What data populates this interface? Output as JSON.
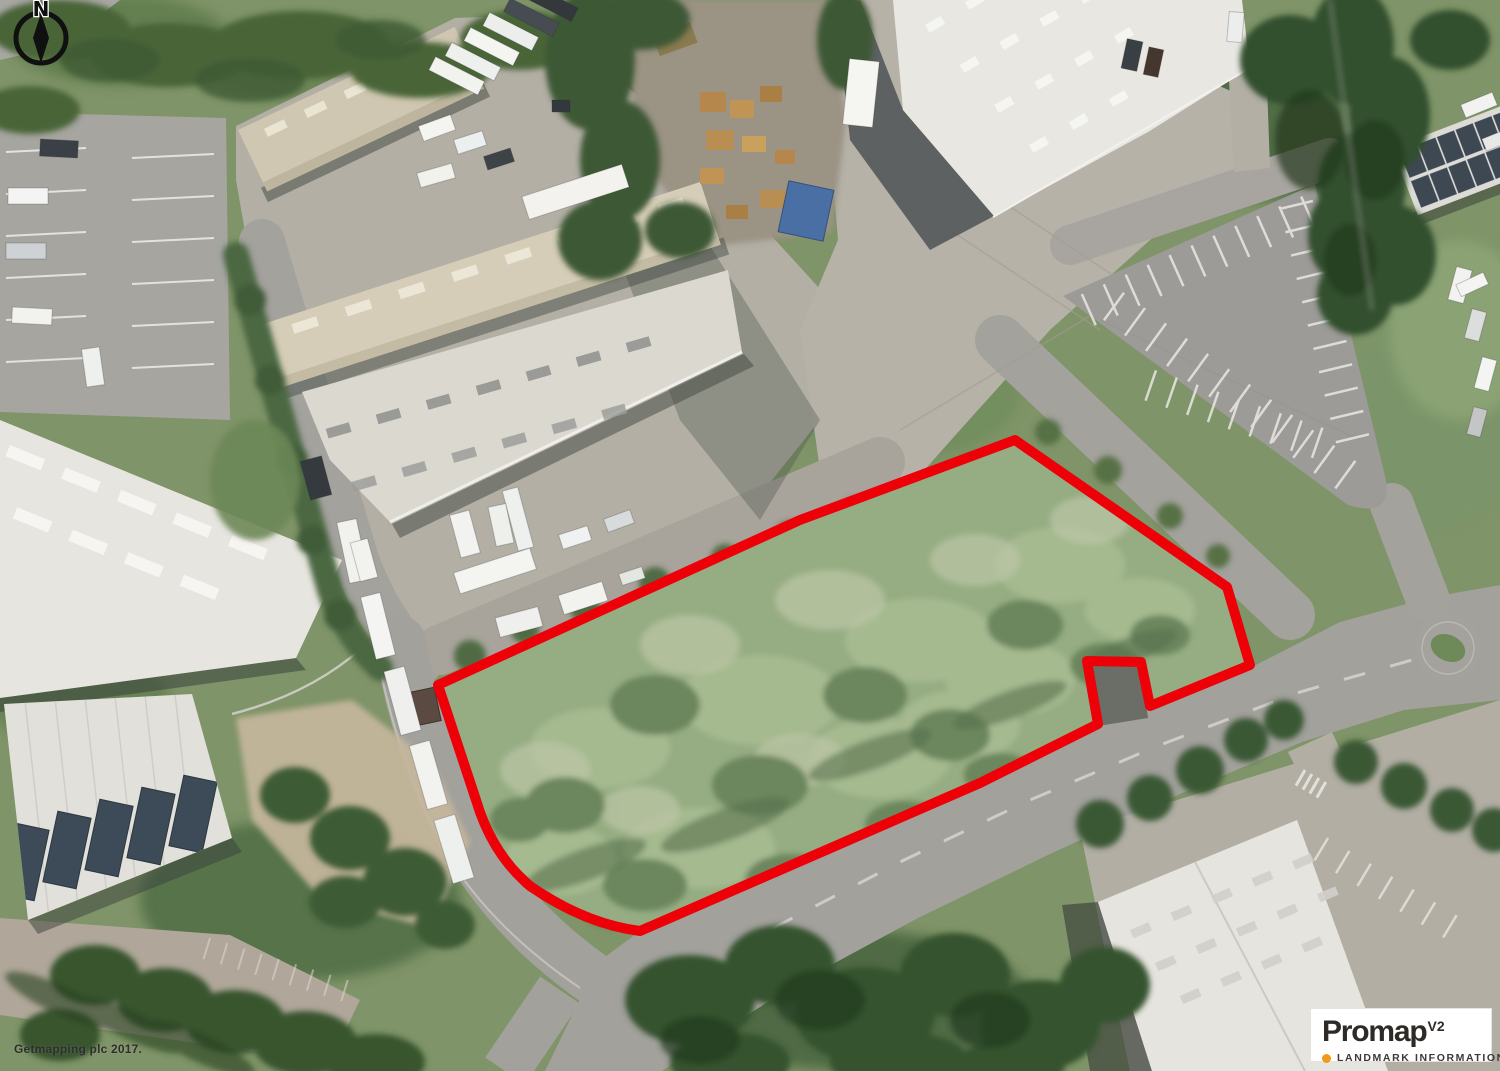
{
  "map": {
    "north_label": "N",
    "copyright": "Getmapping plc 2017."
  },
  "logo": {
    "brand": "Promap",
    "version": "V2",
    "subtitle": "LANDMARK INFORMATION",
    "accent_color": "#F0991C",
    "background": "#FFFFFF",
    "text_color": "#2E2A26"
  },
  "boundary": {
    "color": "#EE0008",
    "stroke_width_px": 10
  }
}
